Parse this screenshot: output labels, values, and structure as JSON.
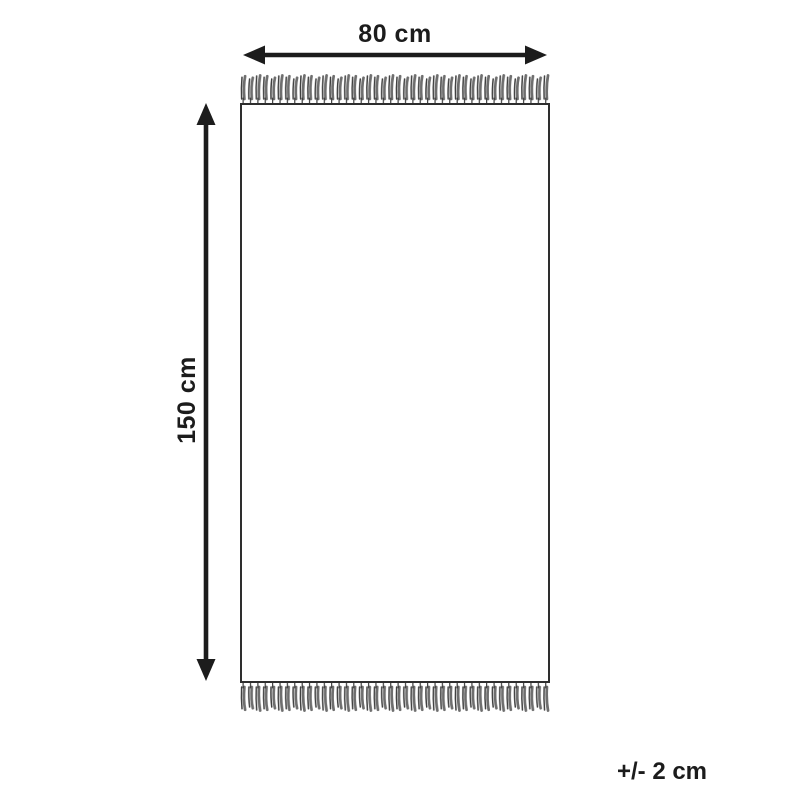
{
  "diagram": {
    "width_label": "80 cm",
    "height_label": "150 cm",
    "tolerance_label": "+/- 2 cm",
    "colors": {
      "background": "#ffffff",
      "outline": "#2e2e2e",
      "arrow": "#1c1c1c",
      "text": "#1c1c1c",
      "fringe_dark": "#3f3f3f",
      "fringe_light": "#6e6e6e"
    }
  }
}
